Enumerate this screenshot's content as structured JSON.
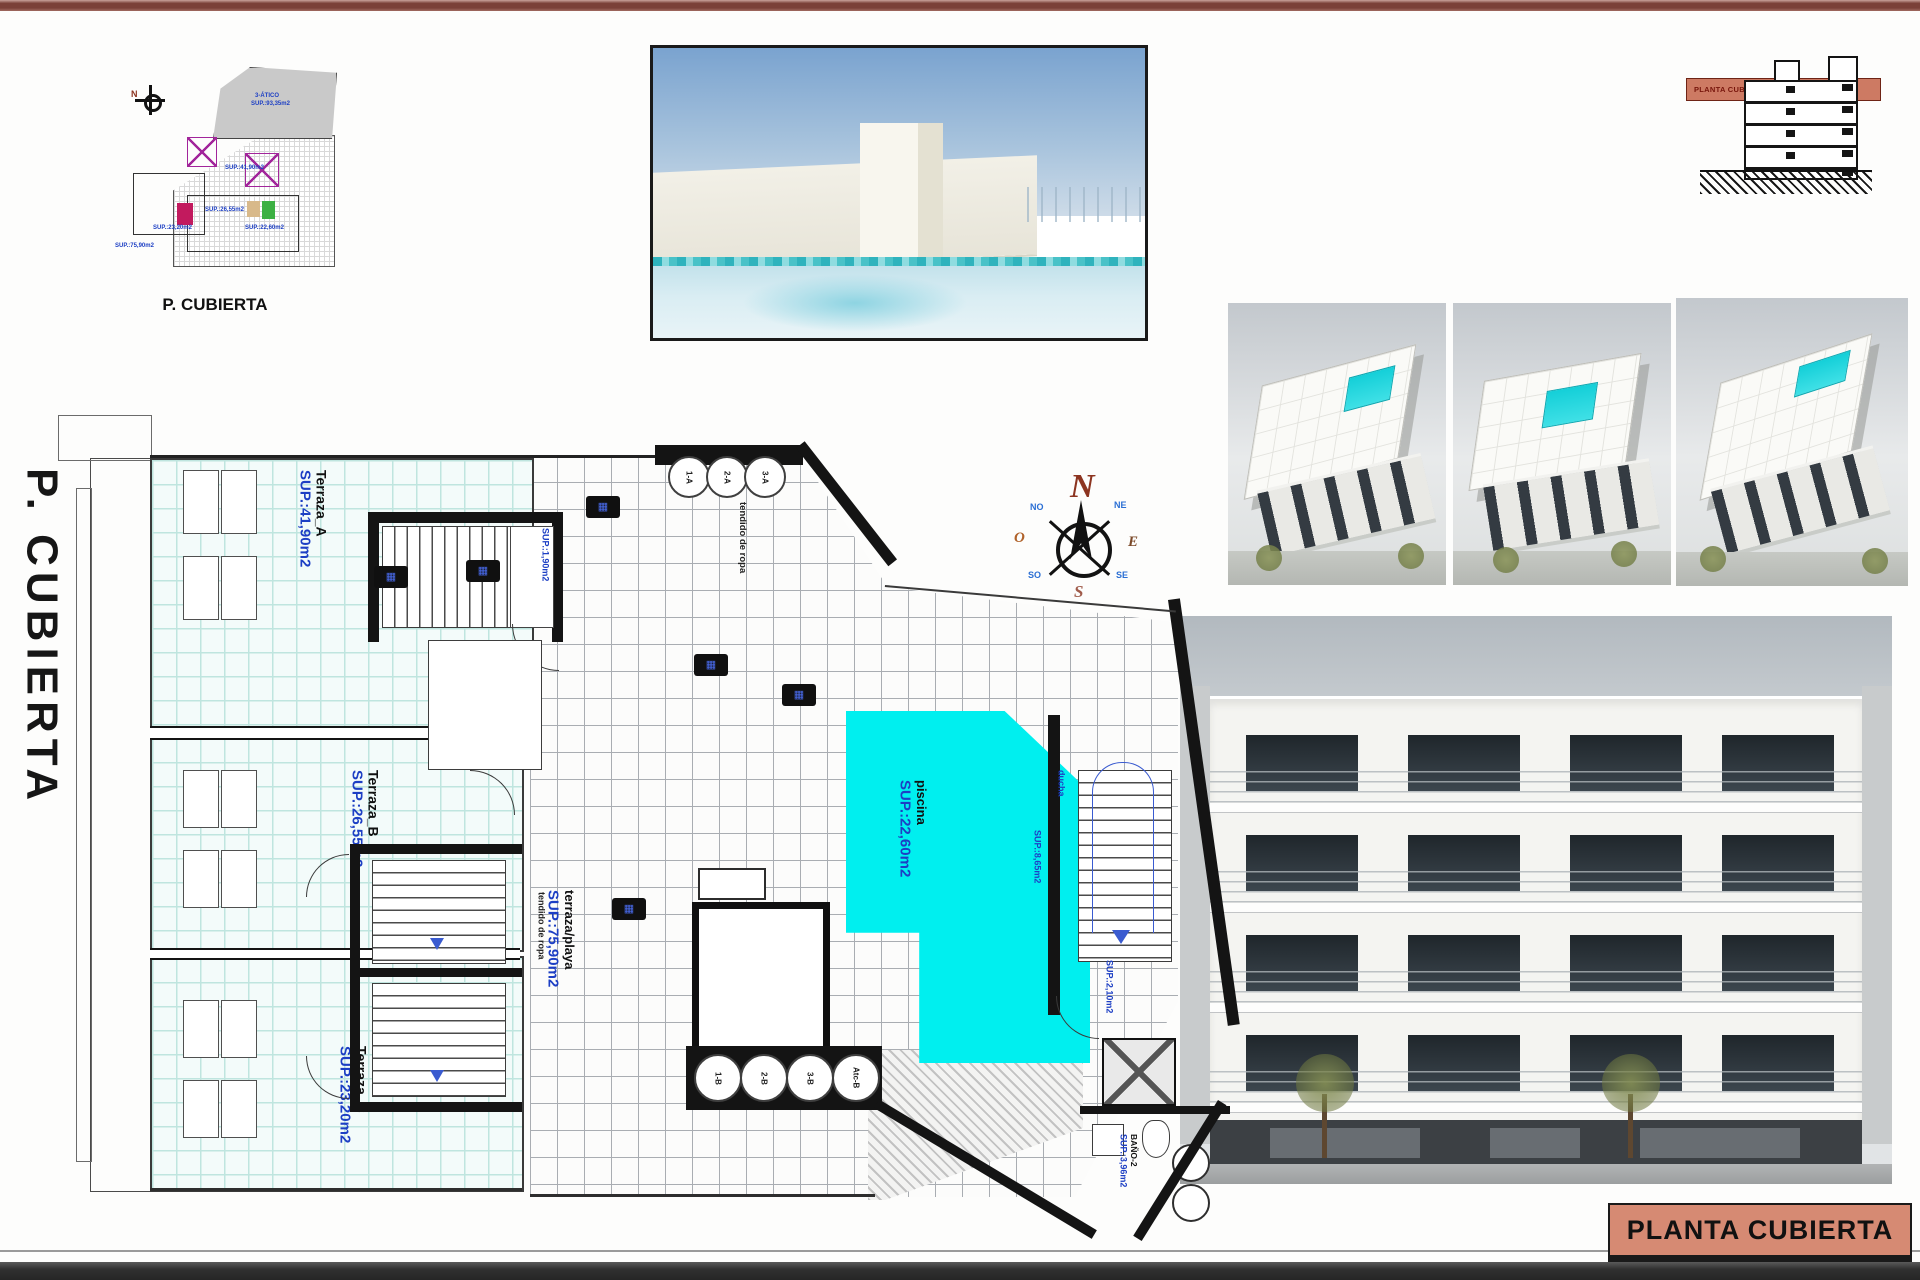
{
  "colors": {
    "accent_maroon": "#7a4038",
    "banner_salmon": "#d68a73",
    "pool_cyan": "#00efef",
    "label_blue": "#1d3fc4",
    "bottom_bar": "#303030"
  },
  "site_plan": {
    "caption": "P. CUBIERTA",
    "north": "N",
    "atico_name": "3-ÁTICO",
    "atico_sup": "SUP.:93,35m2",
    "mini_labels": [
      "SUP.:41,90m2",
      "SUP.:26,55m2",
      "SUP.:23,20m2",
      "SUP.:75,90m2",
      "SUP.:22,60m2"
    ]
  },
  "section_thumb": {
    "band_label": "PLANTA CUBIERTA"
  },
  "plan": {
    "vertical_title": "P. CUBIERTA",
    "terraces": [
      {
        "name": "Terraza_A",
        "sup": "SUP.:41,90m2"
      },
      {
        "name": "Terraza_B",
        "sup": "SUP.:26,55m2"
      },
      {
        "name": "Terraza_C",
        "sup": "SUP.:23,20m2"
      }
    ],
    "beach": {
      "name": "terraza/playa",
      "sup": "SUP.:75,90m2"
    },
    "pool": {
      "name": "piscina",
      "sup": "SUP.:22,60m2"
    },
    "bath": {
      "name": "BAÑO-2",
      "sup": "SUP.:3,96m2"
    },
    "stair_a_sup": "SUP.:1,90m2",
    "stair_right_sup": "SUP.:2,10m2",
    "deck_sup": "SUP.:8,65m2",
    "shower": "ducha",
    "laundry_top": "tendido de ropa",
    "laundry_left": "tendido de ropa",
    "skylights_top": [
      "1-A",
      "2-A",
      "3-A"
    ],
    "skylights_bottom": [
      "1-B",
      "2-B",
      "3-B",
      "Atc-B"
    ],
    "compass": {
      "n": "N",
      "s": "S",
      "e": "E",
      "o": "O",
      "ne": "NE",
      "nw": "NO",
      "se": "SE",
      "sw": "SO"
    }
  },
  "title_block": {
    "label": "PLANTA CUBIERTA"
  }
}
